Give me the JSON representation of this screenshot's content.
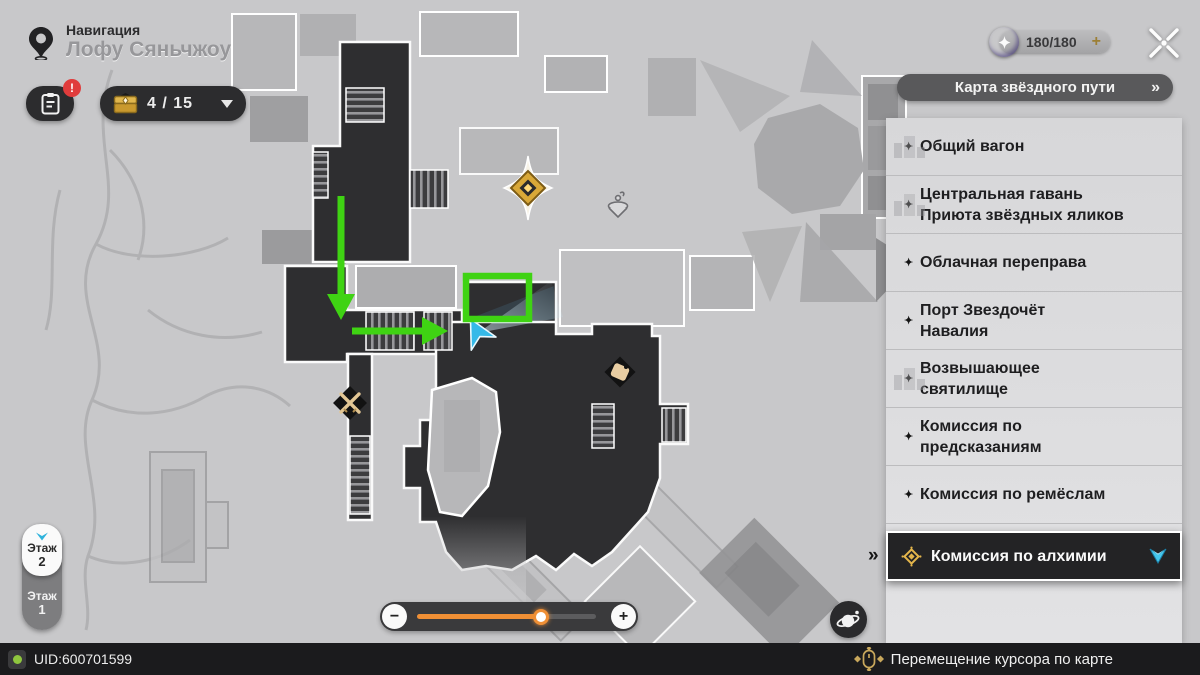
{
  "colors": {
    "annotation_green": "#3fd313",
    "player_cyan": "#38b8e6",
    "accent_gold": "#d7a63f",
    "slider_orange": "#ef8f35",
    "badge_red": "#e03c3c",
    "selected_row_bg": "#232325"
  },
  "header": {
    "nav_label": "Навигация",
    "location_name": "Лофу Сяньчжоу",
    "journal_badge": "!",
    "chest_counter": "4 / 15",
    "energy_value": "180/180",
    "energy_add": "+"
  },
  "sidebar": {
    "title": "Карта звёздного пути",
    "title_arrow": "»",
    "selected_marker": "»",
    "item_icon": "✦",
    "items": [
      {
        "label": "Общий вагон",
        "sketch": true
      },
      {
        "label": "Центральная гавань\nПриюта звёздных яликов",
        "sketch": true
      },
      {
        "label": "Облачная переправа"
      },
      {
        "label": "Порт Звездочёт\nНавалия"
      },
      {
        "label": "Возвышающее\nсвятилище",
        "sketch": true
      },
      {
        "label": "Комиссия по\nпредсказаниям"
      },
      {
        "label": "Комиссия по ремёслам"
      },
      {
        "label": "Комиссия по алхимии",
        "selected": true
      }
    ]
  },
  "floor_selector": {
    "floors": [
      {
        "word": "Этаж",
        "num": "2",
        "selected": true
      },
      {
        "word": "Этаж",
        "num": "1"
      }
    ]
  },
  "zoom_control": {
    "minus": "−",
    "plus": "+",
    "value_pct": 69
  },
  "status_bar": {
    "uid": "UID:600701599",
    "hint": "Перемещение курсора по карте"
  }
}
